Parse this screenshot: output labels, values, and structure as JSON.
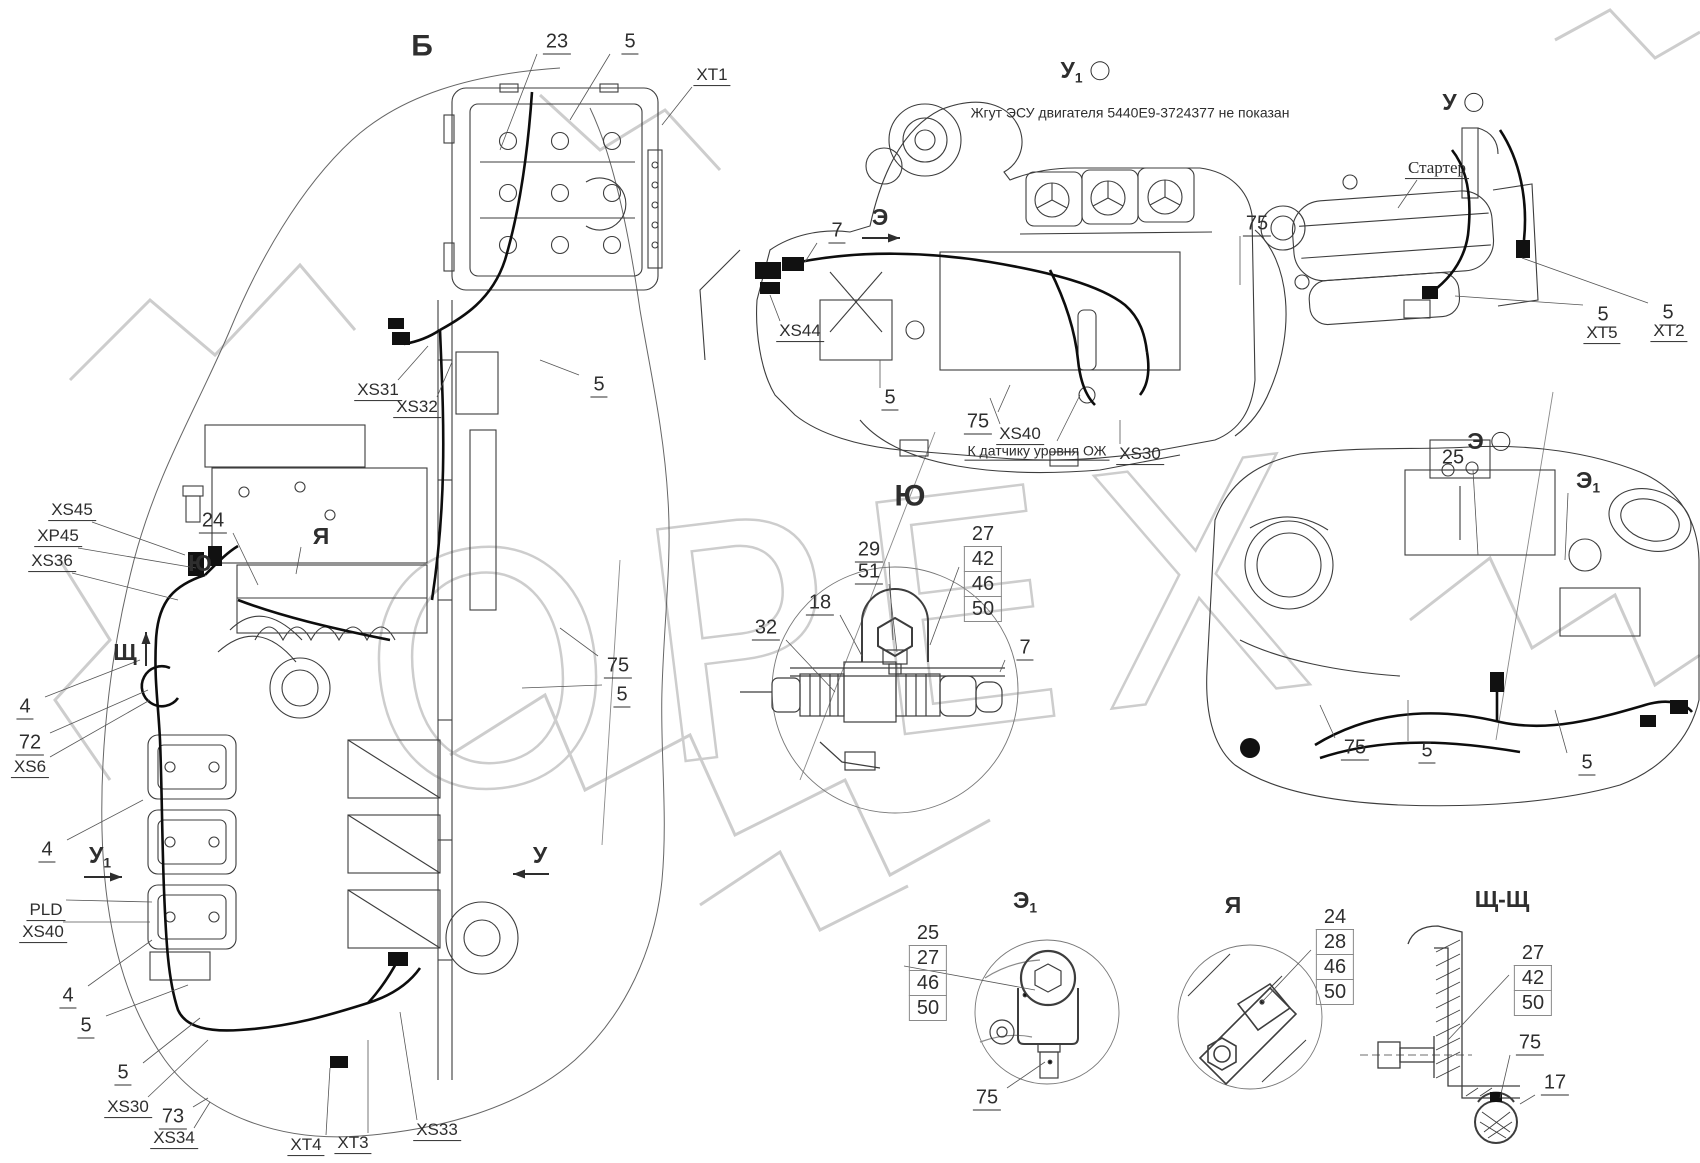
{
  "watermark": {
    "text": "ОРЕХ"
  },
  "callouts": [
    {
      "t": "Б",
      "x": 422,
      "y": 46,
      "cls": "title"
    },
    {
      "t": "23",
      "x": 557,
      "y": 43,
      "cls": "num",
      "ul": true,
      "lx": 500,
      "ly": 150
    },
    {
      "t": "5",
      "x": 630,
      "y": 43,
      "cls": "num",
      "ul": true,
      "lx": 570,
      "ly": 120
    },
    {
      "t": "XT1",
      "x": 712,
      "y": 76,
      "cls": "code",
      "ul": true,
      "lx": 662,
      "ly": 125
    },
    {
      "t": "XS31",
      "x": 378,
      "y": 391,
      "cls": "code",
      "ul": true,
      "lx": 428,
      "ly": 346
    },
    {
      "t": "XS32",
      "x": 417,
      "y": 408,
      "cls": "code",
      "ul": true,
      "lx": 452,
      "ly": 362
    },
    {
      "t": "5",
      "x": 599,
      "y": 386,
      "cls": "num",
      "ul": true,
      "lx": 540,
      "ly": 360
    },
    {
      "t": "XS45",
      "x": 72,
      "y": 511,
      "cls": "code",
      "ul": true,
      "lx": 185,
      "ly": 555
    },
    {
      "t": "XP45",
      "x": 58,
      "y": 537,
      "cls": "code",
      "ul": true,
      "lx": 196,
      "ly": 568
    },
    {
      "t": "XS36",
      "x": 52,
      "y": 562,
      "cls": "code",
      "ul": true,
      "lx": 178,
      "ly": 600
    },
    {
      "t": "24",
      "x": 213,
      "y": 522,
      "cls": "num",
      "ul": true,
      "lx": 258,
      "ly": 585
    },
    {
      "t": "Я",
      "x": 321,
      "y": 536,
      "cls": "vlabel",
      "lx": 296,
      "ly": 574
    },
    {
      "t": "Ю",
      "x": 200,
      "y": 563,
      "cls": "vlabel"
    },
    {
      "t": "Щ",
      "x": 125,
      "y": 652,
      "cls": "vlabel"
    },
    {
      "t": "4",
      "x": 25,
      "y": 708,
      "cls": "num",
      "ul": true,
      "lx": 140,
      "ly": 660
    },
    {
      "t": "72",
      "x": 30,
      "y": 744,
      "cls": "num",
      "ul": true,
      "lx": 148,
      "ly": 690
    },
    {
      "t": "XS6",
      "x": 30,
      "y": 768,
      "cls": "code",
      "ul": true,
      "lx": 150,
      "ly": 700
    },
    {
      "t": "4",
      "x": 47,
      "y": 851,
      "cls": "num",
      "ul": true,
      "lx": 143,
      "ly": 800
    },
    {
      "t": "У",
      "sub": "1",
      "x": 100,
      "y": 857,
      "cls": "vlabel"
    },
    {
      "t": "У",
      "x": 540,
      "y": 855,
      "cls": "vlabel"
    },
    {
      "t": "PLD",
      "x": 46,
      "y": 911,
      "cls": "code",
      "ul": true,
      "lx": 152,
      "ly": 902
    },
    {
      "t": "XS40",
      "x": 43,
      "y": 933,
      "cls": "code",
      "ul": true,
      "lx": 150,
      "ly": 922
    },
    {
      "t": "4",
      "x": 68,
      "y": 997,
      "cls": "num",
      "ul": true,
      "lx": 152,
      "ly": 940
    },
    {
      "t": "5",
      "x": 86,
      "y": 1027,
      "cls": "num",
      "ul": true,
      "lx": 188,
      "ly": 985
    },
    {
      "t": "5",
      "x": 123,
      "y": 1074,
      "cls": "num",
      "ul": true,
      "lx": 200,
      "ly": 1018
    },
    {
      "t": "XS30",
      "x": 128,
      "y": 1108,
      "cls": "code",
      "ul": true,
      "lx": 208,
      "ly": 1040
    },
    {
      "t": "73",
      "x": 173,
      "y": 1118,
      "cls": "num",
      "ul": true,
      "lx": 208,
      "ly": 1098
    },
    {
      "t": "XS34",
      "x": 174,
      "y": 1139,
      "cls": "code",
      "ul": true,
      "lx": 210,
      "ly": 1102
    },
    {
      "t": "XT4",
      "x": 306,
      "y": 1146,
      "cls": "code",
      "ul": true,
      "lx": 330,
      "ly": 1068
    },
    {
      "t": "XT3",
      "x": 353,
      "y": 1144,
      "cls": "code",
      "ul": true,
      "lx": 368,
      "ly": 1040
    },
    {
      "t": "XS33",
      "x": 437,
      "y": 1131,
      "cls": "code",
      "ul": true,
      "lx": 400,
      "ly": 1012
    },
    {
      "t": "75",
      "x": 618,
      "y": 667,
      "cls": "num",
      "ul": true,
      "lx": 560,
      "ly": 628
    },
    {
      "t": "5",
      "x": 622,
      "y": 696,
      "cls": "num",
      "ul": true,
      "lx": 522,
      "ly": 688
    },
    {
      "t": "У",
      "sub": "1",
      "x": 1085,
      "y": 72,
      "cls": "vlabel",
      "circle": true
    },
    {
      "t": "Жгут ЭСУ двигателя 5440Е9-3724377 не показан",
      "x": 1130,
      "y": 113,
      "cls": "note"
    },
    {
      "t": "Э",
      "x": 880,
      "y": 217,
      "cls": "vlabel"
    },
    {
      "t": "7",
      "x": 837,
      "y": 232,
      "cls": "num",
      "ul": true,
      "lx": 805,
      "ly": 262
    },
    {
      "t": "XS44",
      "x": 800,
      "y": 332,
      "cls": "code",
      "ul": true,
      "lx": 770,
      "ly": 295
    },
    {
      "t": "5",
      "x": 890,
      "y": 399,
      "cls": "num",
      "ul": true,
      "lx": 880,
      "ly": 360
    },
    {
      "t": "75",
      "x": 978,
      "y": 423,
      "cls": "num",
      "ul": true,
      "lx": 1010,
      "ly": 385
    },
    {
      "t": "XS40",
      "x": 1020,
      "y": 435,
      "cls": "code",
      "ul": true,
      "lx": 990,
      "ly": 398
    },
    {
      "t": "К датчику уровня ОЖ",
      "x": 1037,
      "y": 452,
      "cls": "note",
      "ul": true,
      "lx": 1080,
      "ly": 395
    },
    {
      "t": "XS30",
      "x": 1140,
      "y": 455,
      "cls": "code",
      "ul": true,
      "lx": 1120,
      "ly": 420
    },
    {
      "t": "75",
      "x": 1257,
      "y": 225,
      "cls": "num",
      "ul": true,
      "lx": 1240,
      "ly": 285
    },
    {
      "t": "У",
      "x": 1463,
      "y": 102,
      "cls": "vlabel",
      "circle": true
    },
    {
      "t": "Стартер",
      "x": 1437,
      "y": 169,
      "cls": "note-serif",
      "ul": true,
      "lx": 1398,
      "ly": 208
    },
    {
      "t": "5",
      "x": 1603,
      "y": 316,
      "cls": "num",
      "ul": true,
      "lx": 1455,
      "ly": 296
    },
    {
      "t": "XT5",
      "x": 1602,
      "y": 334,
      "cls": "code",
      "ul": true
    },
    {
      "t": "5",
      "x": 1668,
      "y": 314,
      "cls": "num",
      "ul": true,
      "lx": 1522,
      "ly": 258
    },
    {
      "t": "XT2",
      "x": 1669,
      "y": 332,
      "cls": "code",
      "ul": true
    },
    {
      "t": "Ю",
      "x": 910,
      "y": 496,
      "cls": "title"
    },
    {
      "t": "29",
      "x": 869,
      "y": 551,
      "cls": "num",
      "ul": true,
      "lx": 893,
      "ly": 640
    },
    {
      "t": "51",
      "x": 869,
      "y": 573,
      "cls": "num",
      "ul": true,
      "lx": 897,
      "ly": 652
    },
    {
      "t": "18",
      "x": 820,
      "y": 604,
      "cls": "num",
      "ul": true,
      "lx": 862,
      "ly": 656
    },
    {
      "t": "32",
      "x": 766,
      "y": 629,
      "cls": "num",
      "ul": true,
      "lx": 835,
      "ly": 692
    },
    {
      "t": "7",
      "x": 1025,
      "y": 649,
      "cls": "num",
      "ul": true,
      "lx": 1000,
      "ly": 672
    },
    {
      "t": "Э",
      "x": 1489,
      "y": 441,
      "cls": "vlabel",
      "circle": true
    },
    {
      "t": "25",
      "x": 1453,
      "y": 459,
      "cls": "num",
      "ul": true,
      "lx": 1478,
      "ly": 555
    },
    {
      "t": "Э",
      "sub": "1",
      "x": 1588,
      "y": 482,
      "cls": "vlabel",
      "lx": 1565,
      "ly": 560
    },
    {
      "t": "75",
      "x": 1355,
      "y": 749,
      "cls": "num",
      "ul": true,
      "lx": 1320,
      "ly": 705
    },
    {
      "t": "5",
      "x": 1427,
      "y": 752,
      "cls": "num",
      "ul": true,
      "lx": 1408,
      "ly": 700
    },
    {
      "t": "5",
      "x": 1587,
      "y": 764,
      "cls": "num",
      "ul": true,
      "lx": 1555,
      "ly": 710
    },
    {
      "t": "Э",
      "sub": "1",
      "x": 1025,
      "y": 902,
      "cls": "vlabel"
    },
    {
      "t": "75",
      "x": 987,
      "y": 1099,
      "cls": "num",
      "ul": true,
      "lx": 1045,
      "ly": 1062
    },
    {
      "t": "Я",
      "x": 1233,
      "y": 905,
      "cls": "vlabel"
    },
    {
      "t": "Щ-Щ",
      "x": 1502,
      "y": 899,
      "cls": "vlabel"
    },
    {
      "t": "75",
      "x": 1530,
      "y": 1044,
      "cls": "num",
      "ul": true,
      "lx": 1500,
      "ly": 1098
    },
    {
      "t": "17",
      "x": 1555,
      "y": 1084,
      "cls": "num",
      "ul": true,
      "lx": 1520,
      "ly": 1104
    }
  ],
  "stacks": [
    {
      "x": 983,
      "y": 523,
      "lx": 930,
      "ly": 645,
      "items": [
        {
          "t": "27",
          "box": false
        },
        {
          "t": "42",
          "box": true
        },
        {
          "t": "46",
          "box": true
        },
        {
          "t": "50",
          "box": true
        }
      ]
    },
    {
      "x": 928,
      "y": 922,
      "lx": 1035,
      "ly": 990,
      "items": [
        {
          "t": "25",
          "box": false
        },
        {
          "t": "27",
          "box": true
        },
        {
          "t": "46",
          "box": true
        },
        {
          "t": "50",
          "box": true
        }
      ]
    },
    {
      "x": 1335,
      "y": 906,
      "lx": 1262,
      "ly": 1002,
      "items": [
        {
          "t": "24",
          "box": false
        },
        {
          "t": "28",
          "box": true
        },
        {
          "t": "46",
          "box": true
        },
        {
          "t": "50",
          "box": true
        }
      ]
    },
    {
      "x": 1533,
      "y": 942,
      "lx": 1448,
      "ly": 1040,
      "items": [
        {
          "t": "27",
          "box": false
        },
        {
          "t": "42",
          "box": true
        },
        {
          "t": "50",
          "box": true
        }
      ]
    }
  ],
  "arrows": [
    {
      "dir": "right",
      "x": 862,
      "y": 238,
      "len": 38
    },
    {
      "dir": "up",
      "x": 146,
      "y": 666,
      "len": 34
    },
    {
      "dir": "right",
      "x": 84,
      "y": 877,
      "len": 38
    },
    {
      "dir": "left",
      "x": 549,
      "y": 874,
      "len": 36
    }
  ]
}
